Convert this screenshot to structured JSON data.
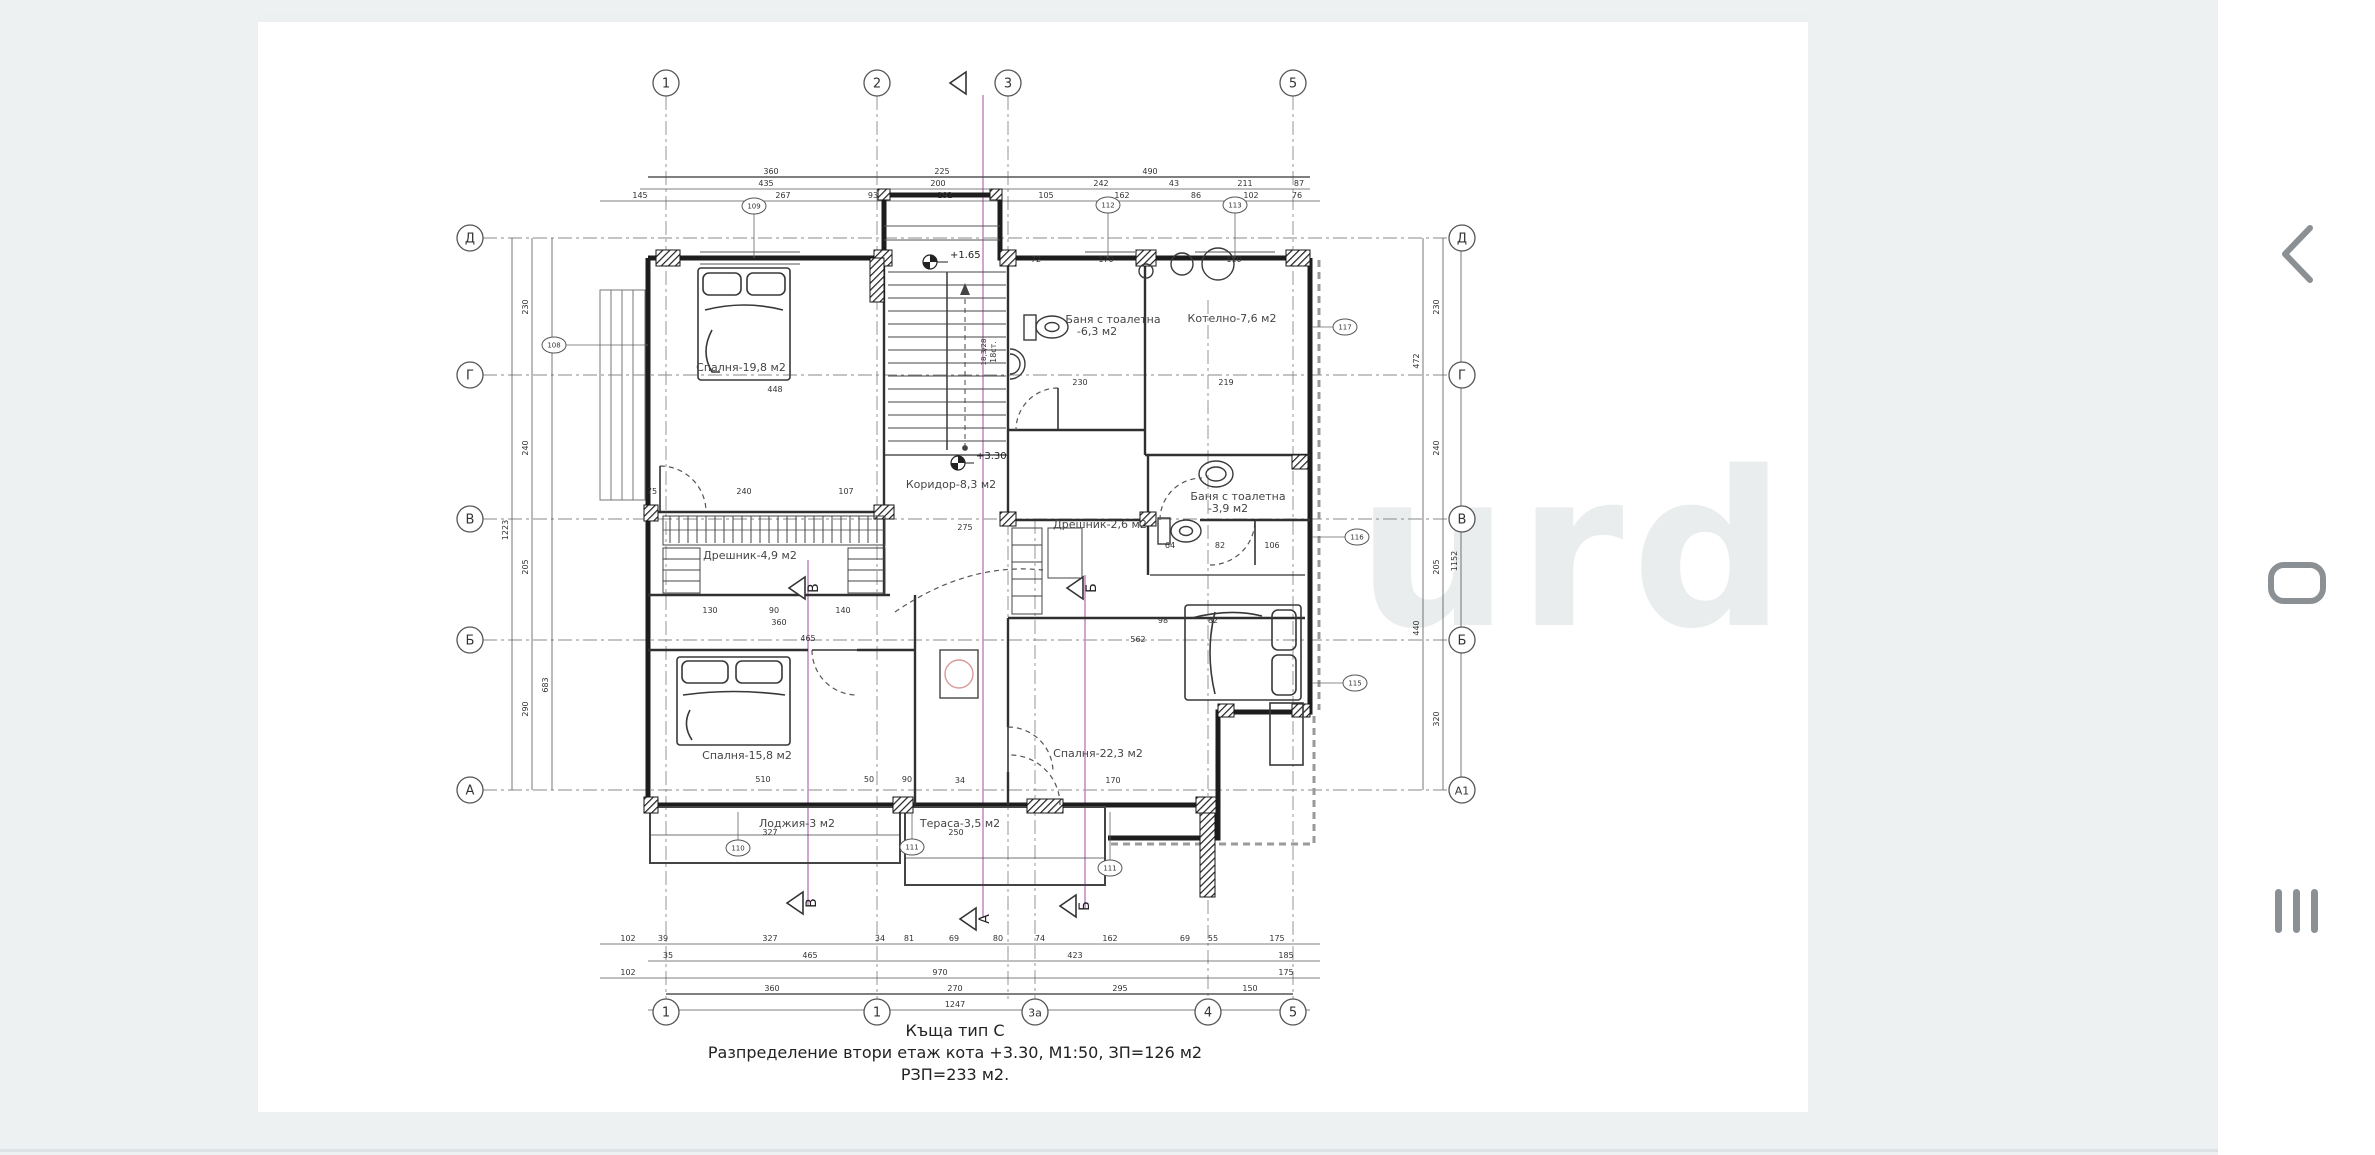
{
  "page": {
    "bg_color": "#eef1f2",
    "doc_bg": "#ffffff",
    "ink_color": "#2b2b2b",
    "section_pink": "#c48fc4",
    "nav_icon_color": "#8b9094",
    "watermark": "urd"
  },
  "caption": {
    "line1": "Къща тип С",
    "line2": "Разпределение втори етаж кота +3.30, М1:50, ЗП=126 м2",
    "line3": "РЗП=233 м2."
  },
  "levels": {
    "upper_landing": "+1.65",
    "floor": "+3.30"
  },
  "stairs": {
    "count_label": "18ст.",
    "step_label": "18,3/28"
  },
  "nav": {
    "back": "back",
    "home": "home",
    "recents": "recents"
  },
  "grid": {
    "top": [
      {
        "label": "1",
        "x": 666
      },
      {
        "label": "2",
        "x": 877
      },
      {
        "label": "3",
        "x": 1008
      },
      {
        "label": "5",
        "x": 1293
      }
    ],
    "bottom": [
      {
        "label": "1",
        "x": 666
      },
      {
        "label": "1",
        "x": 877
      },
      {
        "label": "3а",
        "x": 1035
      },
      {
        "label": "4",
        "x": 1208
      },
      {
        "label": "5",
        "x": 1293
      }
    ],
    "left": [
      {
        "label": "Д",
        "y": 238
      },
      {
        "label": "Г",
        "y": 375
      },
      {
        "label": "В",
        "y": 519
      },
      {
        "label": "Б",
        "y": 640
      },
      {
        "label": "А",
        "y": 790
      }
    ],
    "right": [
      {
        "label": "Д",
        "y": 238
      },
      {
        "label": "Г",
        "y": 375
      },
      {
        "label": "В",
        "y": 519
      },
      {
        "label": "Б",
        "y": 640
      },
      {
        "label": "А1",
        "y": 790
      }
    ]
  },
  "rooms": [
    {
      "t": "Спалня-19,8 м2",
      "x": 741,
      "y": 371
    },
    {
      "t": "Баня с тоалетна",
      "x": 1113,
      "y": 323
    },
    {
      "t": "-6,3 м2",
      "x": 1097,
      "y": 335
    },
    {
      "t": "Котелно-7,6 м2",
      "x": 1232,
      "y": 322
    },
    {
      "t": "Коридор-8,3 м2",
      "x": 951,
      "y": 488
    },
    {
      "t": "Дрешник-4,9 м2",
      "x": 750,
      "y": 559
    },
    {
      "t": "Дрешник-2,6 м2",
      "x": 1100,
      "y": 528
    },
    {
      "t": "Баня с тоалетна",
      "x": 1238,
      "y": 500
    },
    {
      "t": "-3,9 м2",
      "x": 1228,
      "y": 512
    },
    {
      "t": "Спалня-15,8 м2",
      "x": 747,
      "y": 759
    },
    {
      "t": "Спалня-22,3 м2",
      "x": 1098,
      "y": 757
    },
    {
      "t": "Лоджия-3 м2",
      "x": 797,
      "y": 827
    },
    {
      "t": "Тераса-3,5 м2",
      "x": 960,
      "y": 827
    }
  ],
  "sections": [
    {
      "t": "",
      "x": 966,
      "y": 83
    },
    {
      "t": "В",
      "x": 805,
      "y": 588
    },
    {
      "t": "Б",
      "x": 1083,
      "y": 588
    },
    {
      "t": "В",
      "x": 803,
      "y": 903
    },
    {
      "t": "А",
      "x": 976,
      "y": 919
    },
    {
      "t": "Б",
      "x": 1076,
      "y": 906
    }
  ],
  "tags": [
    {
      "x": 754,
      "y": 206,
      "t": "109"
    },
    {
      "x": 1108,
      "y": 205,
      "t": "112"
    },
    {
      "x": 1235,
      "y": 205,
      "t": "113"
    },
    {
      "x": 1345,
      "y": 327,
      "t": "117"
    },
    {
      "x": 1357,
      "y": 537,
      "t": "116"
    },
    {
      "x": 1355,
      "y": 683,
      "t": "115"
    },
    {
      "x": 738,
      "y": 848,
      "t": "110"
    },
    {
      "x": 912,
      "y": 847,
      "t": "111"
    },
    {
      "x": 1110,
      "y": 868,
      "t": "111"
    },
    {
      "x": 554,
      "y": 345,
      "t": "108"
    }
  ],
  "dims": [
    {
      "x": 771,
      "y": 174,
      "t": "360"
    },
    {
      "x": 942,
      "y": 174,
      "t": "225"
    },
    {
      "x": 1150,
      "y": 174,
      "t": "490"
    },
    {
      "x": 766,
      "y": 186,
      "t": "435"
    },
    {
      "x": 938,
      "y": 186,
      "t": "200"
    },
    {
      "x": 1101,
      "y": 186,
      "t": "242"
    },
    {
      "x": 1174,
      "y": 186,
      "t": "43"
    },
    {
      "x": 1245,
      "y": 186,
      "t": "211"
    },
    {
      "x": 1299,
      "y": 186,
      "t": "87"
    },
    {
      "x": 640,
      "y": 198,
      "t": "145"
    },
    {
      "x": 783,
      "y": 198,
      "t": "267"
    },
    {
      "x": 873,
      "y": 198,
      "t": "93"
    },
    {
      "x": 945,
      "y": 198,
      "t": "192"
    },
    {
      "x": 1046,
      "y": 198,
      "t": "105"
    },
    {
      "x": 1122,
      "y": 198,
      "t": "162"
    },
    {
      "x": 1196,
      "y": 198,
      "t": "86"
    },
    {
      "x": 1251,
      "y": 198,
      "t": "102"
    },
    {
      "x": 1297,
      "y": 198,
      "t": "76"
    },
    {
      "x": 628,
      "y": 941,
      "t": "102"
    },
    {
      "x": 663,
      "y": 941,
      "t": "39"
    },
    {
      "x": 770,
      "y": 941,
      "t": "327"
    },
    {
      "x": 880,
      "y": 941,
      "t": "34"
    },
    {
      "x": 909,
      "y": 941,
      "t": "81"
    },
    {
      "x": 954,
      "y": 941,
      "t": "69"
    },
    {
      "x": 998,
      "y": 941,
      "t": "80"
    },
    {
      "x": 1040,
      "y": 941,
      "t": "74"
    },
    {
      "x": 1110,
      "y": 941,
      "t": "162"
    },
    {
      "x": 1185,
      "y": 941,
      "t": "69"
    },
    {
      "x": 1213,
      "y": 941,
      "t": "55"
    },
    {
      "x": 1277,
      "y": 941,
      "t": "175"
    },
    {
      "x": 668,
      "y": 958,
      "t": "35"
    },
    {
      "x": 810,
      "y": 958,
      "t": "465"
    },
    {
      "x": 1075,
      "y": 958,
      "t": "423"
    },
    {
      "x": 1286,
      "y": 958,
      "t": "185"
    },
    {
      "x": 628,
      "y": 975,
      "t": "102"
    },
    {
      "x": 940,
      "y": 975,
      "t": "970"
    },
    {
      "x": 1286,
      "y": 975,
      "t": "175"
    },
    {
      "x": 772,
      "y": 991,
      "t": "360"
    },
    {
      "x": 955,
      "y": 991,
      "t": "270"
    },
    {
      "x": 1120,
      "y": 991,
      "t": "295"
    },
    {
      "x": 1250,
      "y": 991,
      "t": "150"
    },
    {
      "x": 955,
      "y": 1007,
      "t": "1247"
    },
    {
      "x": 528,
      "y": 307,
      "t": "230",
      "r": -90
    },
    {
      "x": 528,
      "y": 448,
      "t": "240",
      "r": -90
    },
    {
      "x": 528,
      "y": 567,
      "t": "205",
      "r": -90
    },
    {
      "x": 528,
      "y": 709,
      "t": "290",
      "r": -90
    },
    {
      "x": 508,
      "y": 530,
      "t": "1223",
      "r": -90
    },
    {
      "x": 548,
      "y": 685,
      "t": "683",
      "r": -90
    },
    {
      "x": 1439,
      "y": 307,
      "t": "230",
      "r": -90
    },
    {
      "x": 1439,
      "y": 448,
      "t": "240",
      "r": -90
    },
    {
      "x": 1439,
      "y": 567,
      "t": "205",
      "r": -90
    },
    {
      "x": 1439,
      "y": 719,
      "t": "320",
      "r": -90
    },
    {
      "x": 1419,
      "y": 361,
      "t": "472",
      "r": -90
    },
    {
      "x": 1419,
      "y": 628,
      "t": "440",
      "r": -90
    },
    {
      "x": 1457,
      "y": 561,
      "t": "1152",
      "r": -90
    },
    {
      "x": 652,
      "y": 494,
      "t": "75"
    },
    {
      "x": 744,
      "y": 494,
      "t": "240"
    },
    {
      "x": 846,
      "y": 494,
      "t": "107"
    },
    {
      "x": 775,
      "y": 392,
      "t": "448"
    },
    {
      "x": 965,
      "y": 530,
      "t": "275"
    },
    {
      "x": 1138,
      "y": 642,
      "t": "562"
    },
    {
      "x": 808,
      "y": 641,
      "t": "465"
    },
    {
      "x": 779,
      "y": 625,
      "t": "360"
    },
    {
      "x": 710,
      "y": 613,
      "t": "130"
    },
    {
      "x": 774,
      "y": 613,
      "t": "90"
    },
    {
      "x": 843,
      "y": 613,
      "t": "140"
    },
    {
      "x": 763,
      "y": 782,
      "t": "510"
    },
    {
      "x": 770,
      "y": 835,
      "t": "327"
    },
    {
      "x": 869,
      "y": 782,
      "t": "50"
    },
    {
      "x": 907,
      "y": 782,
      "t": "90"
    },
    {
      "x": 960,
      "y": 783,
      "t": "34"
    },
    {
      "x": 956,
      "y": 835,
      "t": "250"
    },
    {
      "x": 1113,
      "y": 783,
      "t": "170"
    },
    {
      "x": 1163,
      "y": 623,
      "t": "98"
    },
    {
      "x": 1213,
      "y": 623,
      "t": "82"
    },
    {
      "x": 1170,
      "y": 548,
      "t": "64"
    },
    {
      "x": 1220,
      "y": 548,
      "t": "82"
    },
    {
      "x": 1272,
      "y": 548,
      "t": "106"
    },
    {
      "x": 1080,
      "y": 385,
      "t": "230"
    },
    {
      "x": 1226,
      "y": 385,
      "t": "219"
    },
    {
      "x": 1036,
      "y": 262,
      "t": "72"
    },
    {
      "x": 1106,
      "y": 262,
      "t": "170"
    },
    {
      "x": 1234,
      "y": 262,
      "t": "110"
    }
  ]
}
